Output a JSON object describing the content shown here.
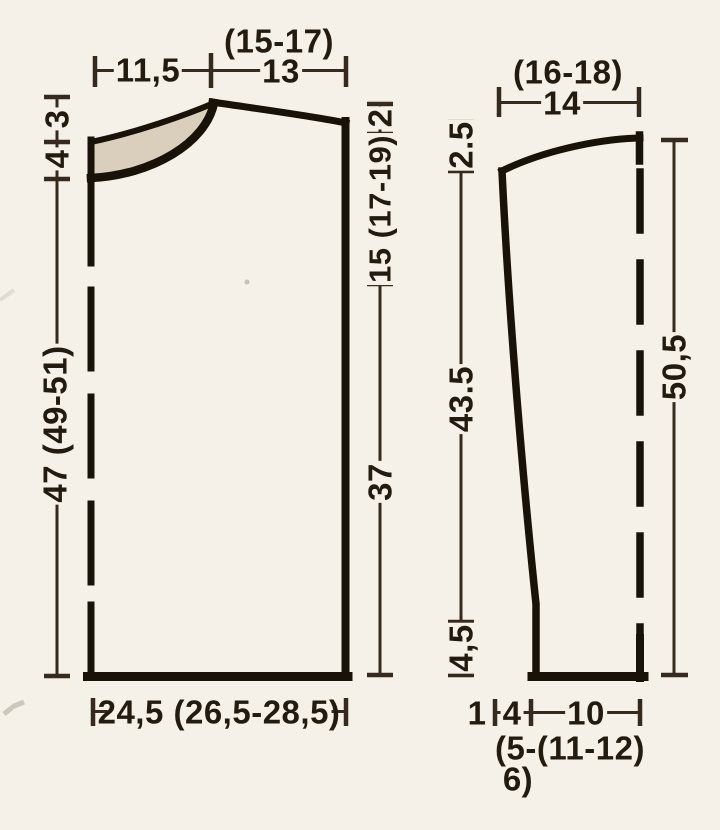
{
  "colors": {
    "paper": "#f5f1e8",
    "ink_outline": "#191209",
    "ink_dim": "#352a1d",
    "ink_text": "#241b10",
    "band_fill": "#d9cfbc"
  },
  "body_piece": {
    "top_sizes": "(15-17)",
    "top_left_width": "11,5",
    "top_right_width": "13",
    "left_top_segment": "3",
    "left_band_segment": "4",
    "left_length": "47 (49-51)",
    "right_shoulder_drop": "2",
    "right_upper_length": "15 (17-19)",
    "right_lower_length": "37",
    "bottom_width": "24,5 (26,5-28,5)"
  },
  "sleeve_piece": {
    "top_sizes": "(16-18)",
    "top_width": "14",
    "cap_height": "2.5",
    "side_length": "43.5",
    "cuff_height": "4,5",
    "total_length": "50,5",
    "bottom_left_segment": "1",
    "bottom_mid_segment": "4",
    "bottom_right_segment": "10",
    "bottom_sizes_line1": "(5-(11-12)",
    "bottom_sizes_line2": "6)"
  }
}
